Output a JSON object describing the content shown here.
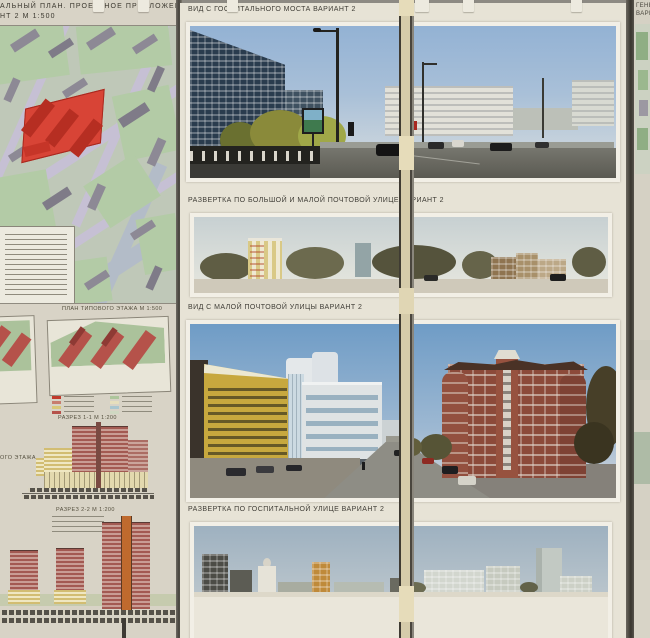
{
  "left_board": {
    "title_line1": "АЛЬНЫЙ ПЛАН. ПРОЕКТНОЕ ПРЕДЛОЖЕНИЕ",
    "title_line2": "НТ 2  М 1:500",
    "floor_plan_title": "ПЛАН ТИПОВОГО ЭТАЖА  М 1:500",
    "left_edge_partial_label": "ОГО ЭТАЖА",
    "section_1_title": "РАЗРЕЗ 1-1  М 1:200",
    "section_2_title": "РАЗРЕЗ 2-2  М 1:200"
  },
  "middle_board": {
    "caption_view_bridge": "ВИД С ГОСПИТАЛЬНОГО МОСТА ВАРИАНТ 2",
    "caption_elevation_pochtovaya": "РАЗВЕРТКА ПО БОЛЬШОЙ И МАЛОЙ ПОЧТОВОЙ УЛИЦЕ ВАРИАНТ 2",
    "caption_view_pochtovaya": "ВИД  С МАЛОЙ ПОЧТОВОЙ УЛИЦЫ ВАРИАНТ 2",
    "caption_elevation_gospitalnaya": "РАЗВЕРТКА ПО ГОСПИТАЛЬНОЙ УЛИЦЕ ВАРИАНТ 2"
  },
  "right_board": {
    "title_line1": "ГЕНЕ",
    "title_line2": "ВАРИ"
  },
  "colors": {
    "wall": "#8d8a83",
    "paper": "#d8d3c6",
    "map_green": "#b3cba6",
    "map_street": "#c6c0d4",
    "project_red": "#d84436",
    "section_pink": "#a35a52",
    "section_yellow": "#d2bd72",
    "brick_red": "#8c4a3a",
    "caption_text": "#3f3d36"
  }
}
